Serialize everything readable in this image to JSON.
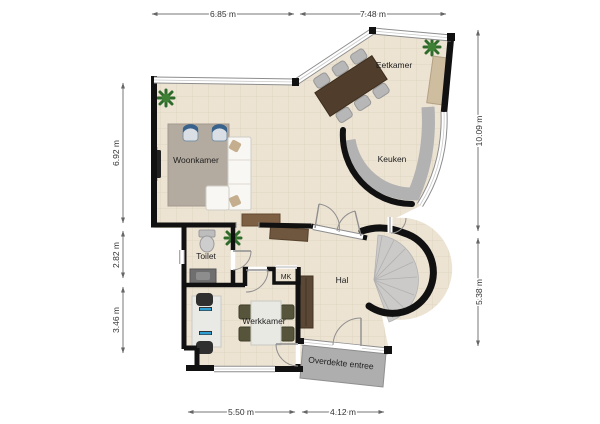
{
  "plan": {
    "rooms": {
      "woonkamer": "Woonkamer",
      "eetkamer": "Eetkamer",
      "keuken": "Keuken",
      "toilet": "Toilet",
      "hal": "Hal",
      "werkkamer": "Werkkamer",
      "mk": "MK",
      "entree": "Overdekte entree"
    },
    "dimensions": {
      "top": [
        "6.85 m",
        "7.48 m"
      ],
      "left": [
        "6.92 m",
        "2.82 m",
        "3.46 m"
      ],
      "right": [
        "10.09 m",
        "5.38 m"
      ],
      "bottom": [
        "5.50 m",
        "4.12 m"
      ]
    },
    "colors": {
      "wall": "#111111",
      "floor": "#ece3d3",
      "counter": "#b7b7b7",
      "stairs": "#cbcac8",
      "rug": "#b4aba0",
      "entree_area": "#aeaeae",
      "armchair": "#38628c",
      "dining_table": "#503d2b"
    }
  }
}
